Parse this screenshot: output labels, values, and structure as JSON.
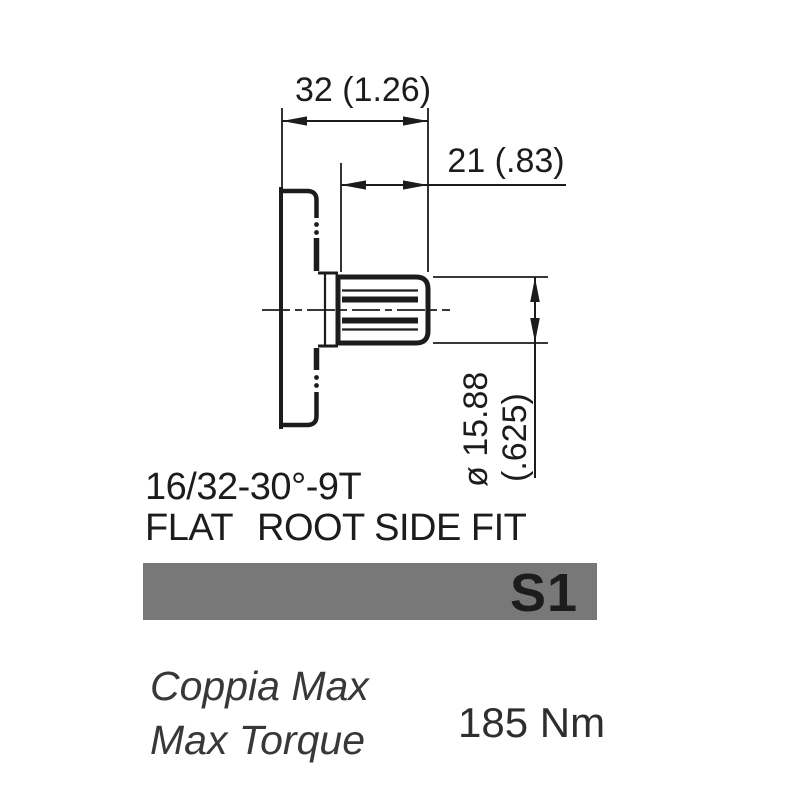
{
  "page": {
    "background": "#ffffff",
    "line_color": "#1c1c1c"
  },
  "drawing": {
    "dimensions": {
      "total_length": "32 (1.26)",
      "spline_length": "21 (.83)",
      "diameter_mm": "ø 15.88",
      "diameter_in": "(.625)"
    },
    "spline_spec": {
      "line1": "16/32-30°-9T",
      "line2_word1": "FLAT",
      "line2_rest": "ROOT SIDE FIT"
    }
  },
  "banner": {
    "label": "S1",
    "background": "#787878",
    "text_color": "#ffffff"
  },
  "torque": {
    "label_italian": "Coppia Max",
    "label_english": "Max Torque",
    "value": "185 Nm"
  }
}
